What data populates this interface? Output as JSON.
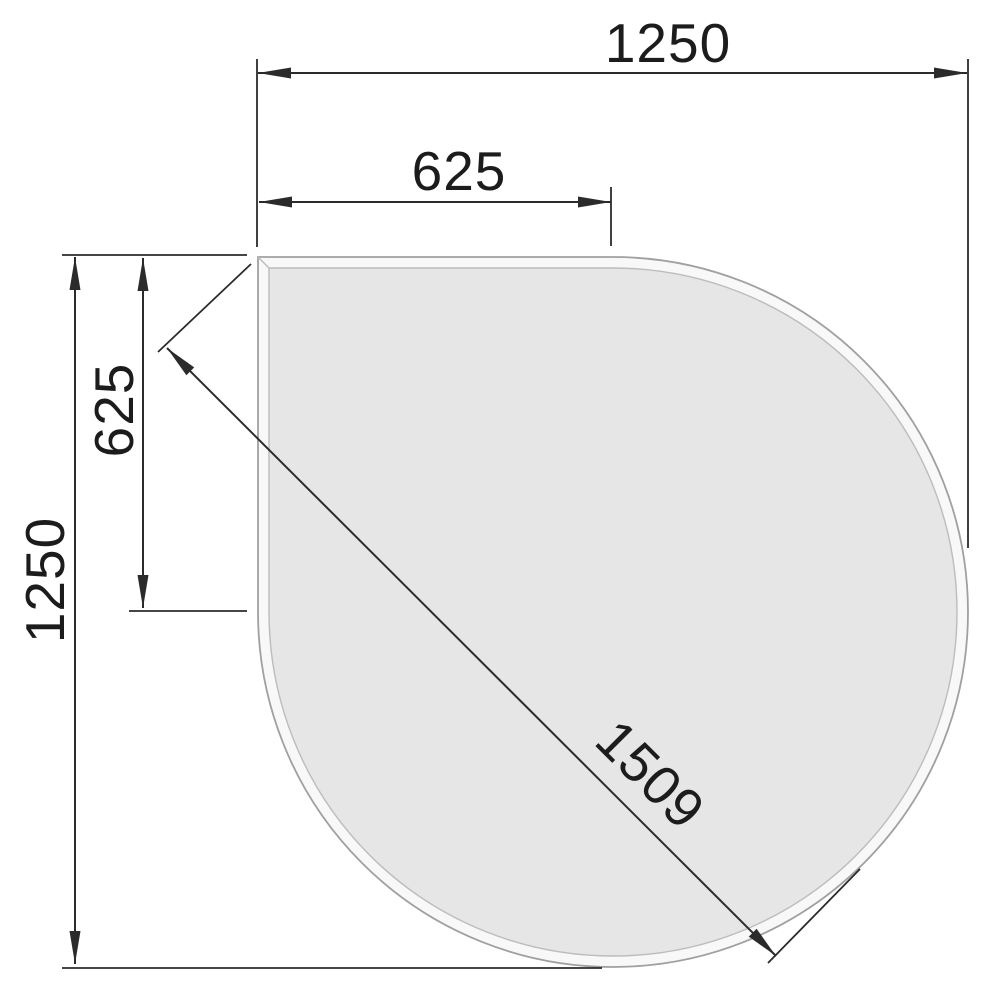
{
  "drawing": {
    "background_color": "#ffffff",
    "dimension_line_color": "#2b2b2b",
    "text_color": "#1c1c1c",
    "shape": {
      "name": "teardrop-plate",
      "surface_color": "#e6e6e6",
      "bevel_color": "#f8f8f8",
      "outer_edge_color": "#a0a0a0",
      "inner_edge_color": "#bcbcbc"
    },
    "dimensions": {
      "top_width": "1250",
      "top_half_width": "625",
      "left_height": "1250",
      "left_half_height": "625",
      "diagonal_length": "1509"
    }
  }
}
